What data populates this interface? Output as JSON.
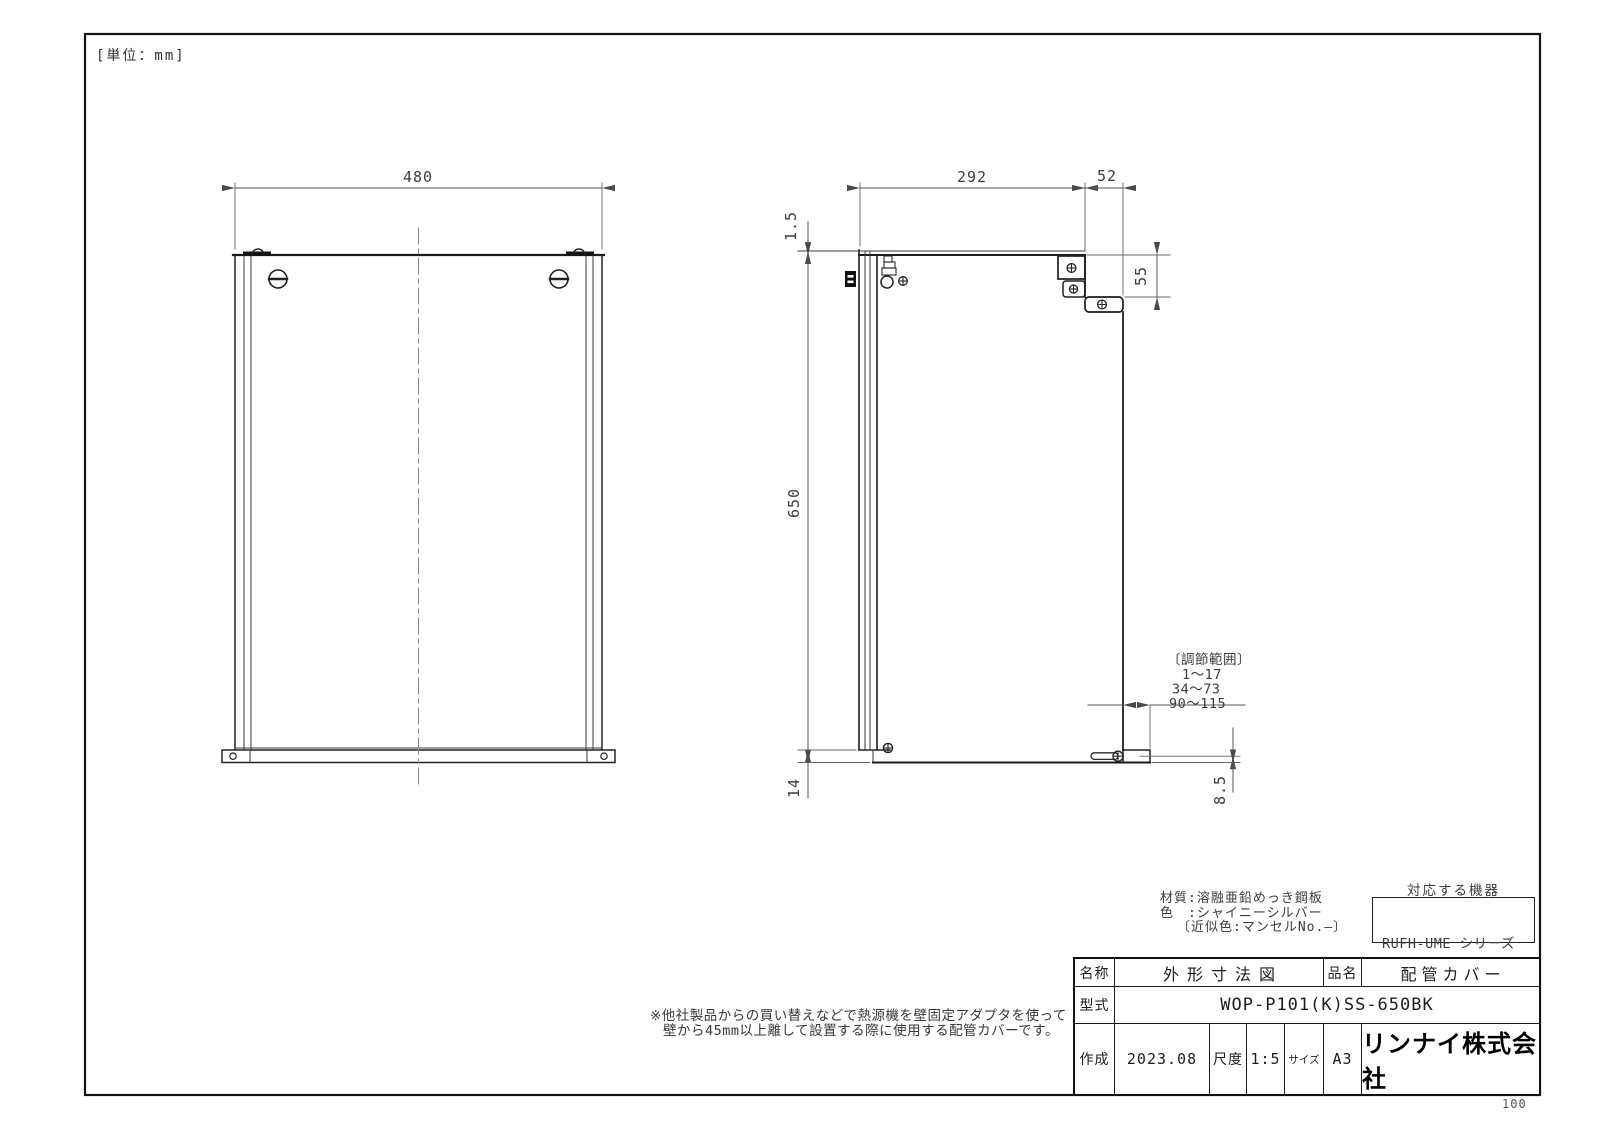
{
  "sheet": {
    "unit_label": "[単位：mm]",
    "page_number": "100"
  },
  "front_view": {
    "width_dim": "480"
  },
  "side_view": {
    "top_depth_dim": "292",
    "front_depth_dim": "52",
    "wall_gap_dim": "1.5",
    "step_dim": "55",
    "height_dim": "650",
    "bottom_dim": "14",
    "foot_dim": "8.5",
    "adjust_range": {
      "title": "〔調節範囲〕",
      "range1": "1～17",
      "range2": "34～73",
      "range3": "90～115"
    }
  },
  "notes": {
    "material_line1": "材質:溶融亜鉛めっき鋼板",
    "material_line2": "色　:シャイニーシルバー",
    "material_line3": "〔近似色:マンセルNo.—〕",
    "usage_line1": "※他社製品からの買い替えなどで熱源機を壁固定アダプタを使って",
    "usage_line2": "壁から45mm以上離して設置する際に使用する配管カバーです。"
  },
  "compatible": {
    "title": "対応する機器",
    "items": [
      "RUFH-UME シリーズ",
      "RUFH-ME  シリーズ"
    ]
  },
  "title_block": {
    "name_label": "名称",
    "name_value": "外形寸法図",
    "item_label": "品名",
    "item_value": "配管カバー",
    "model_label": "型式",
    "model_value": "WOP-P101(K)SS-650BK",
    "created_label": "作成",
    "created_value": "2023.08",
    "scale_label": "尺度",
    "scale_value": "1:5",
    "size_label": "サイズ",
    "size_value": "A3",
    "company": "リンナイ株式会社"
  }
}
